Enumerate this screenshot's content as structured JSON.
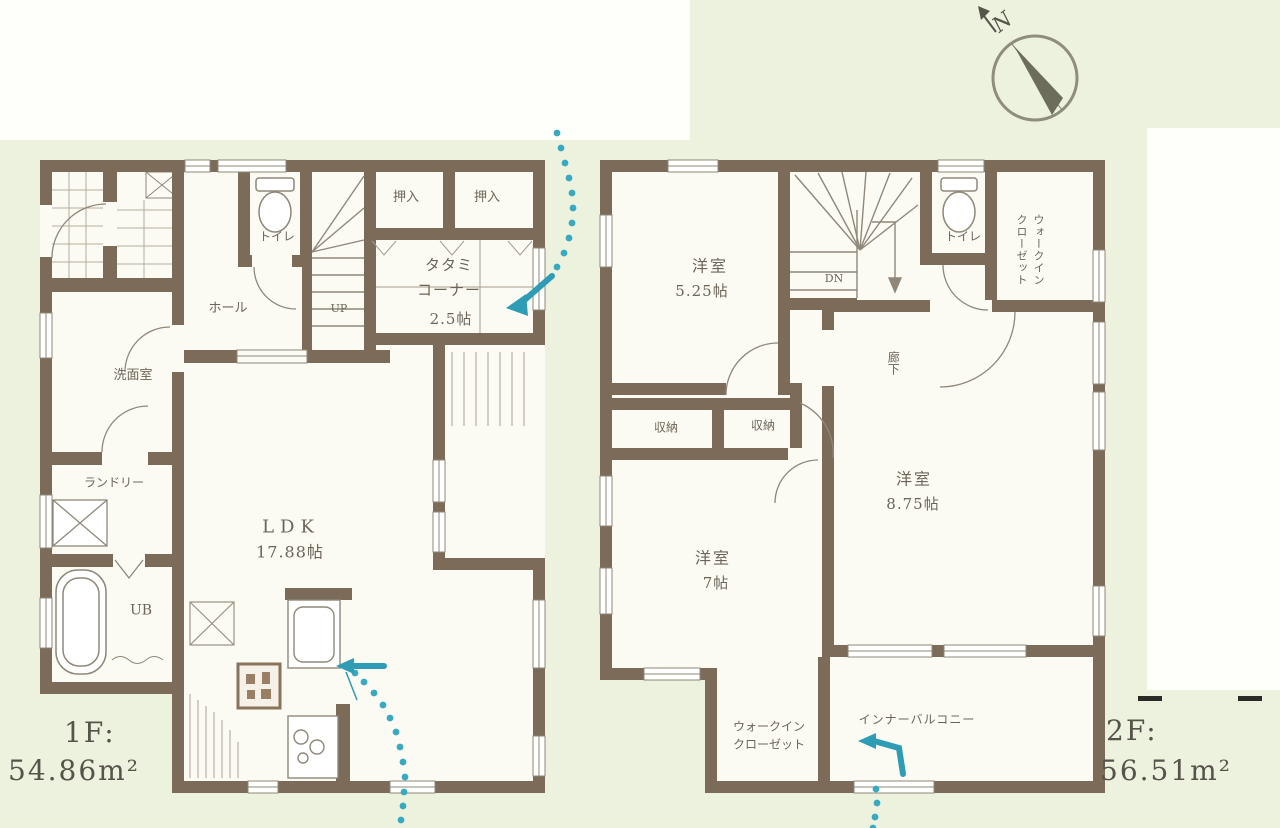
{
  "meta": {
    "type": "japanese-residential-floor-plan",
    "colors": {
      "background": "#edf2df",
      "paper_white": "#fefefb",
      "wall_brown": "#7b6b58",
      "floor_white": "#fbfaf3",
      "thin_line": "#8f887a",
      "label_text": "#6c6557",
      "flow_teal": "#38a9c0"
    }
  },
  "compass": {
    "north": "N"
  },
  "floor1": {
    "area_label": "1F:",
    "area_value": "54.86m²",
    "rooms": {
      "toilet": "トイレ",
      "closet_a": "押入",
      "closet_b": "押入",
      "tatami1": "タタミ",
      "tatami2": "コーナー",
      "tatami3": "2.5帖",
      "hall": "ホール",
      "up": "UP",
      "washroom": "洗面室",
      "laundry": "ランドリー",
      "bath": "UB",
      "ldk1": "LDK",
      "ldk2": "17.88帖"
    }
  },
  "floor2": {
    "area_label": "2F:",
    "area_value": "56.51m²",
    "rooms": {
      "bedroom1a": "洋室",
      "bedroom1b": "5.25帖",
      "dn": "DN",
      "toilet": "トイレ",
      "wic_top_a": "ウォークイン",
      "wic_top_b": "クローゼット",
      "hallway": "廊下",
      "storage_a": "収納",
      "storage_b": "収納",
      "bedroom2a": "洋室",
      "bedroom2b": "8.75帖",
      "bedroom3a": "洋室",
      "bedroom3b": "7帖",
      "wic_bottom_a": "ウォークイン",
      "wic_bottom_b": "クローゼット",
      "balcony": "インナーバルコニー"
    }
  }
}
